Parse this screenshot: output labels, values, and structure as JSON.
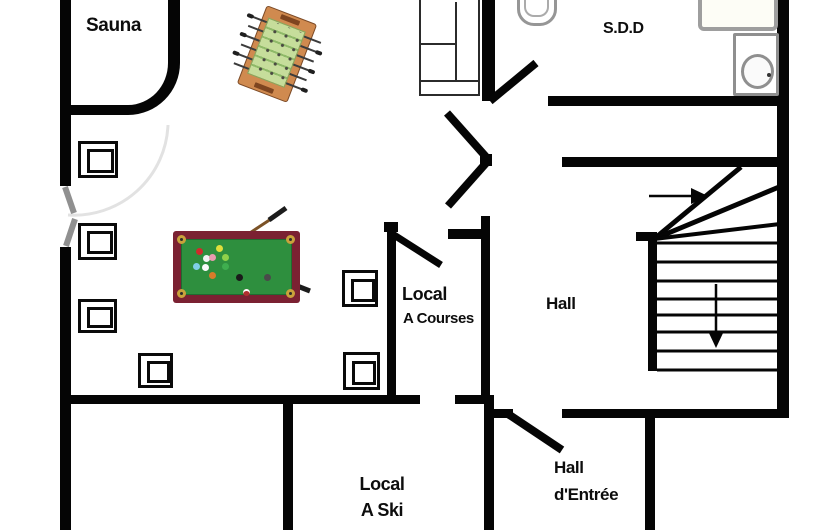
{
  "title": "Basement floor plan",
  "rooms": {
    "sauna": {
      "label": "Sauna"
    },
    "sdd": {
      "label": "S.D.D"
    },
    "hall": {
      "label": "Hall"
    },
    "local_courses": {
      "label_line1": "Local",
      "label_line2": "A Courses"
    },
    "local_ski": {
      "label_line1": "Local",
      "label_line2": "A Ski"
    },
    "hall_entree": {
      "label_line1": "Hall",
      "label_line2": "d'Entrée"
    }
  },
  "furniture": {
    "games_room": [
      "pool-table",
      "foosball-table",
      "sofa",
      "square-stool x6"
    ],
    "sdd_fixtures": [
      "toilet",
      "shower",
      "washbasin"
    ],
    "stool_count": 6
  },
  "stairs": {
    "step_count": 8,
    "winder_count": 3,
    "up_arrow_direction": "right",
    "down_arrow_direction": "down"
  },
  "doors": {
    "swing_count": 5,
    "double_door_location": "games-room-to-hall",
    "window_marks_on_left_wall": 2
  },
  "colors": {
    "wall": "#050505",
    "text": "#0d0d0d",
    "pool_frame": "#7b2132",
    "pool_felt": "#2e8f3e",
    "pocket_gold": "#c9a23b",
    "foosball_frame": "#d08a4f",
    "foosball_field": "#c6dd9b",
    "foosball_stripe": "#8fb968",
    "fixture_gray": "#969696",
    "window_mark_gray": "#909090"
  }
}
